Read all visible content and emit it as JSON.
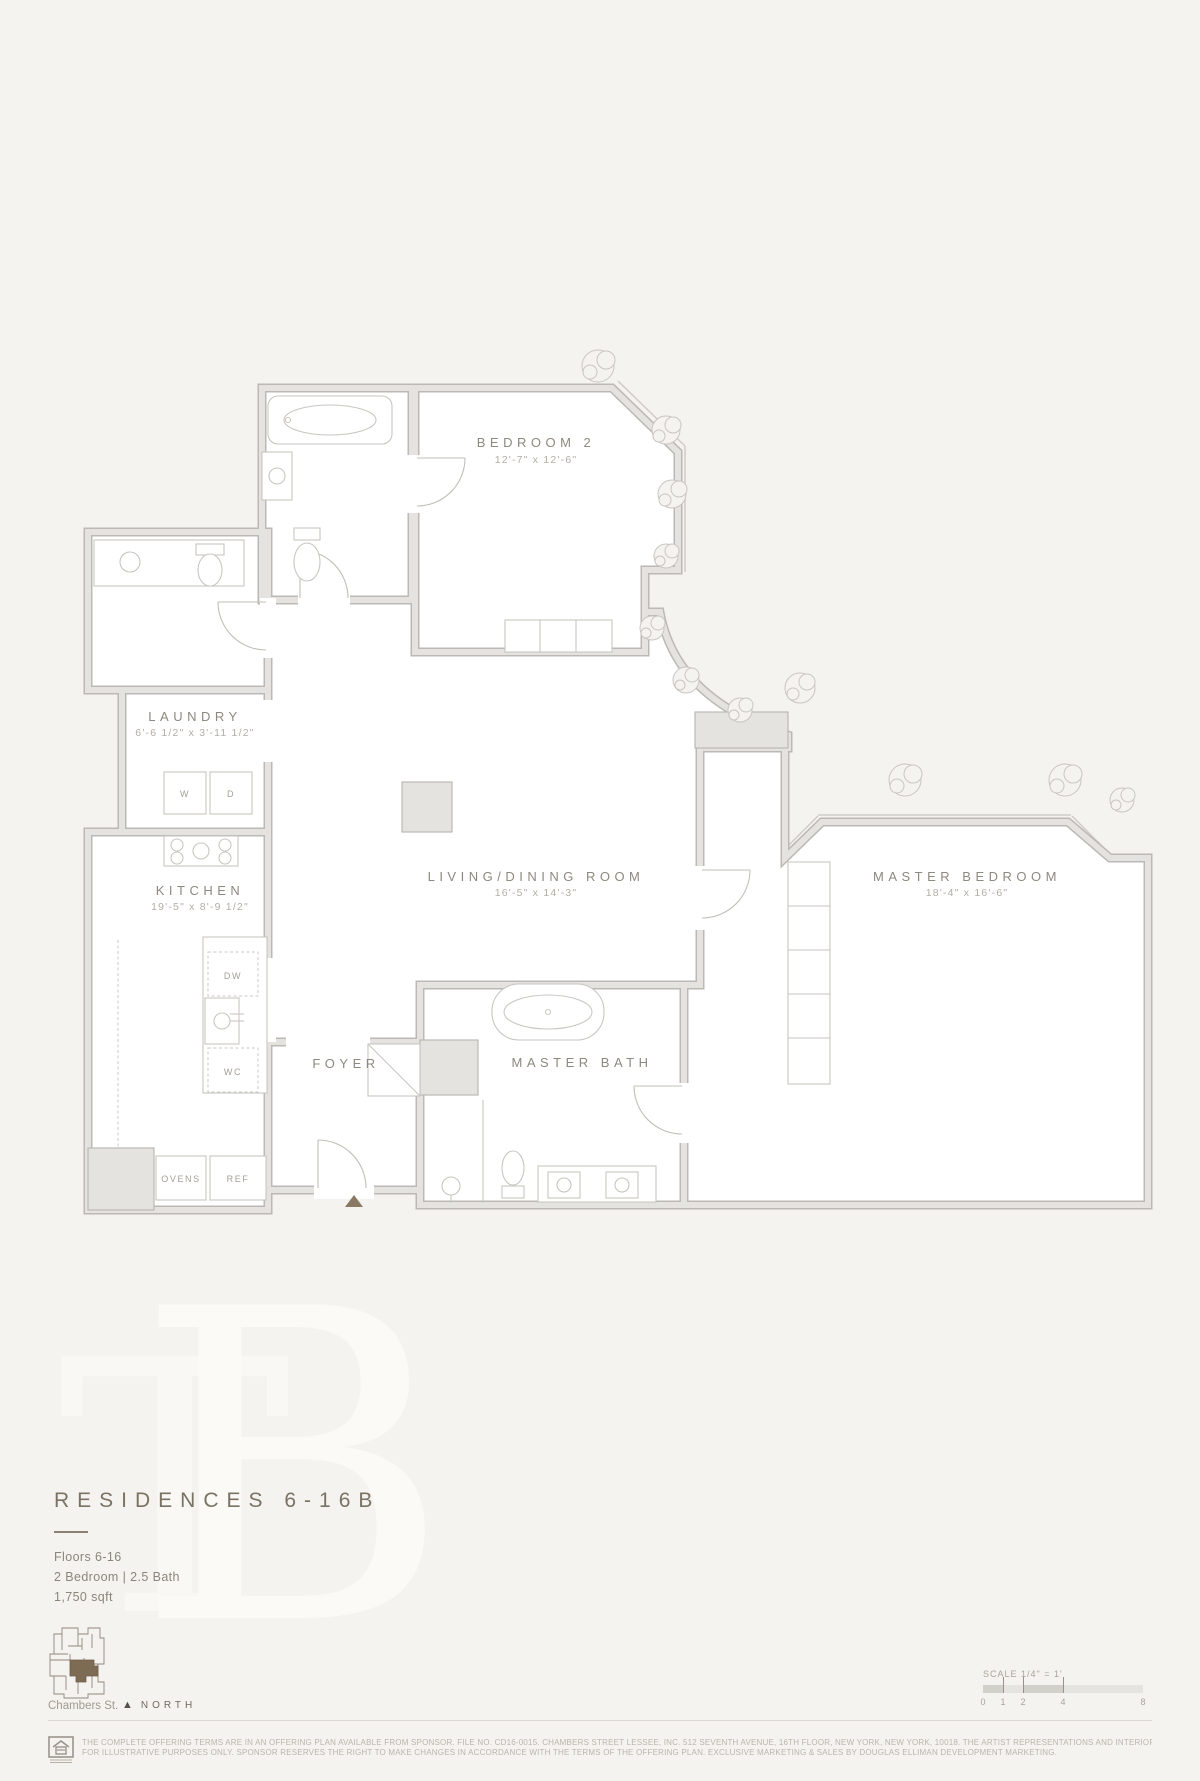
{
  "colors": {
    "background": "#f5f3ef",
    "wall_fill": "#e5e3df",
    "wall_edge": "#bcb9b4",
    "accent_brown": "#7d6b54",
    "label_gray": "#8e897f"
  },
  "plan": {
    "rooms": {
      "bedroom2": {
        "label": "BEDROOM 2",
        "dims": "12'-7\" x 12'-6\""
      },
      "laundry": {
        "label": "LAUNDRY",
        "dims": "6'-6 1/2\" x 3'-11 1/2\""
      },
      "kitchen": {
        "label": "KITCHEN",
        "dims": "19'-5\" x 8'-9 1/2\""
      },
      "living": {
        "label": "LIVING/DINING ROOM",
        "dims": "16'-5\" x 14'-3\""
      },
      "master_bedroom": {
        "label": "MASTER BEDROOM",
        "dims": "18'-4\" x 16'-6\""
      },
      "master_bath": {
        "label": "MASTER BATH"
      },
      "foyer": {
        "label": "FOYER"
      }
    },
    "appliances": {
      "washer": "W",
      "dryer": "D",
      "dishwasher": "DW",
      "wine_cooler": "WC",
      "ovens": "OVENS",
      "refrigerator": "REF"
    }
  },
  "logo": {
    "monogram_primary": "B",
    "monogram_secondary": "T"
  },
  "title_block": {
    "title": "RESIDENCES 6-16B",
    "floors": "Floors 6-16",
    "configuration": "2 Bedroom | 2.5 Bath",
    "area": "1,750 sqft"
  },
  "key_plan": {
    "street": "Chambers St.",
    "north_arrow": "▲",
    "north_label": "NORTH"
  },
  "scale_bar": {
    "label": "SCALE 1/4\" = 1'",
    "ticks": [
      "0",
      "1",
      "2",
      "4",
      "8"
    ]
  },
  "footer": {
    "line1": "THE COMPLETE OFFERING TERMS ARE IN AN OFFERING PLAN AVAILABLE FROM SPONSOR. FILE NO. CD16-0015. CHAMBERS STREET LESSEE, INC. 512 SEVENTH AVENUE, 16TH FLOOR, NEW YORK, NEW YORK, 10018. THE ARTIST REPRESENTATIONS AND INTERIOR DECORATIONS, FINISHES, APPLIANCES AND FURNISHINGS ARE PROVIDED",
    "line2": "FOR ILLUSTRATIVE PURPOSES ONLY. SPONSOR RESERVES THE RIGHT TO MAKE CHANGES IN ACCORDANCE WITH THE TERMS OF THE OFFERING PLAN. EXCLUSIVE MARKETING & SALES BY DOUGLAS ELLIMAN DEVELOPMENT MARKETING."
  }
}
